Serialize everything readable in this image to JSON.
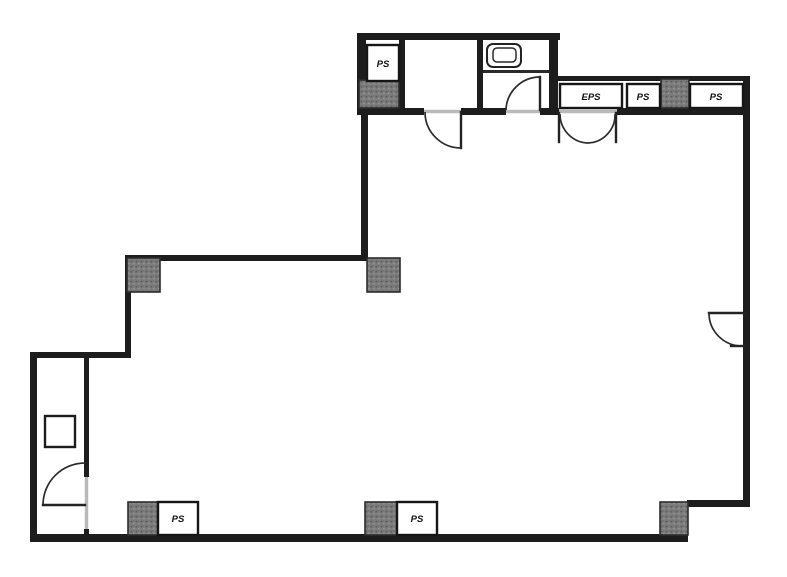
{
  "plan": {
    "labels": {
      "pipe_shaft_top_left": "PS",
      "electrical_pipe_shaft": "EPS",
      "pipe_shaft_top_mid": "PS",
      "pipe_shaft_top_right": "PS",
      "pipe_shaft_bottom_left": "PS",
      "pipe_shaft_bottom_right": "PS"
    },
    "colors": {
      "wall": "#1d1d1d",
      "column_fill": "#7a7a7a",
      "column_speckle": "#5d5d5d",
      "threshold": "#b9b9b9",
      "door_line": "#2b2b2b",
      "background": "#ffffff"
    }
  }
}
